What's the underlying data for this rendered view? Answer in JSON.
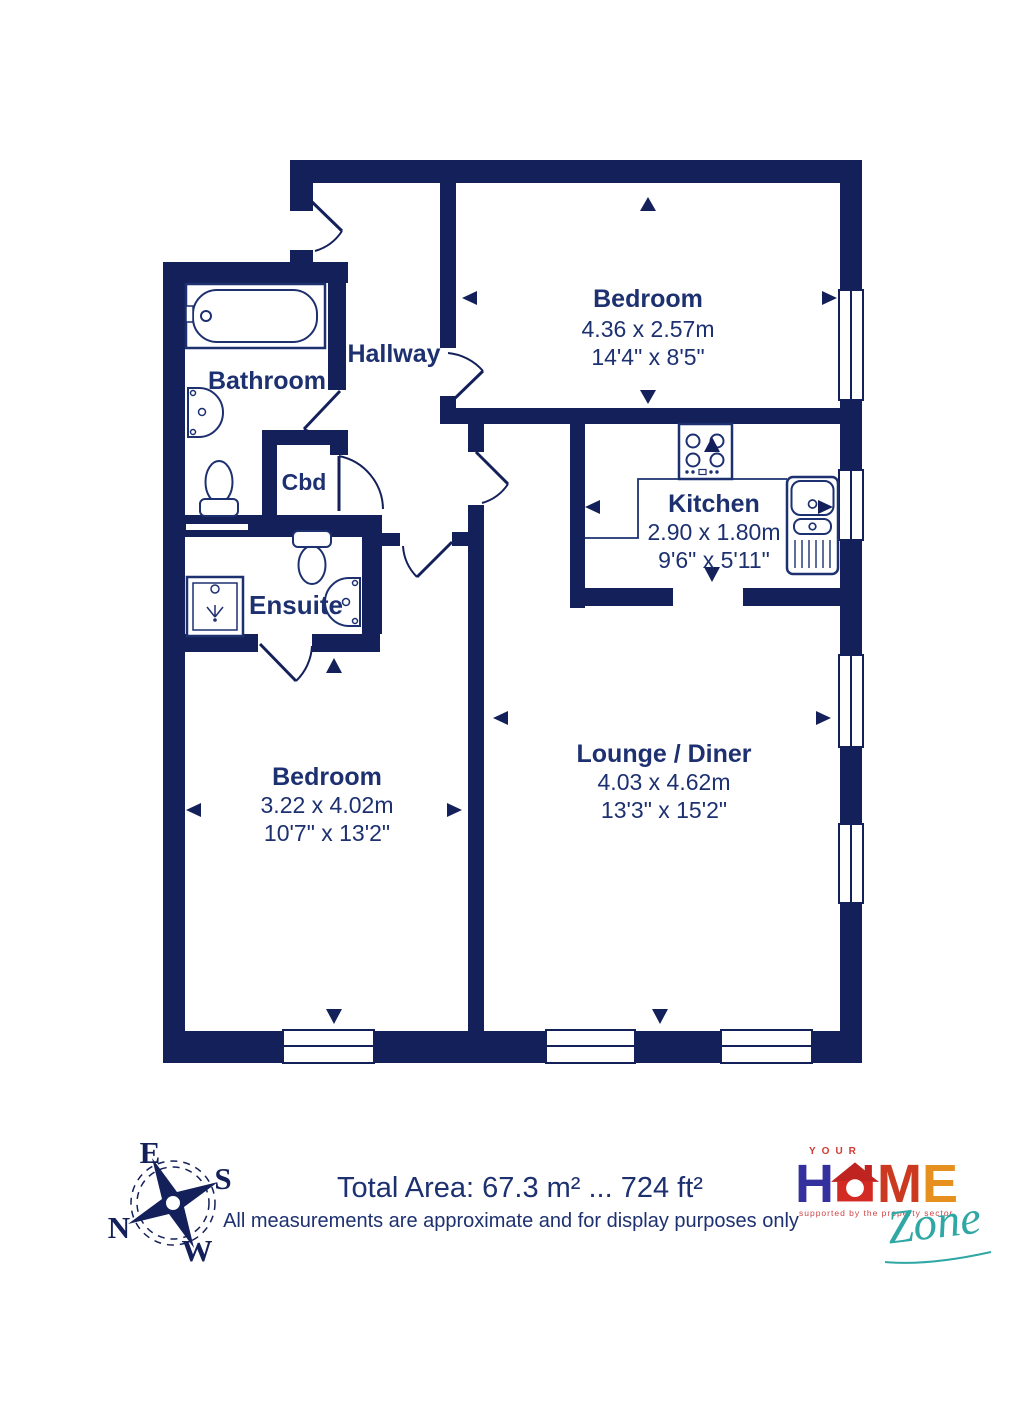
{
  "plan": {
    "wall_color": "#14205a",
    "text_color": "#1d3070",
    "rooms": {
      "bedroom_top": {
        "label": "Bedroom",
        "size_metric": "4.36 x 2.57m",
        "size_imperial": "14'4\" x 8'5\""
      },
      "kitchen": {
        "label": "Kitchen",
        "size_metric": "2.90 x 1.80m",
        "size_imperial": "9'6\" x 5'11\""
      },
      "lounge": {
        "label": "Lounge / Diner",
        "size_metric": "4.03 x 4.62m",
        "size_imperial": "13'3\" x 15'2\""
      },
      "bedroom_bottom": {
        "label": "Bedroom",
        "size_metric": "3.22 x 4.02m",
        "size_imperial": "10'7\" x 13'2\""
      },
      "hallway": {
        "label": "Hallway"
      },
      "bathroom": {
        "label": "Bathroom"
      },
      "cbd": {
        "label": "Cbd"
      },
      "ensuite": {
        "label": "Ensuite"
      }
    },
    "fixtures": [
      "bathtub",
      "bathroom-sink",
      "bathroom-toilet",
      "ensuite-toilet",
      "shower",
      "ensuite-sink",
      "hob",
      "kitchen-sink-unit"
    ]
  },
  "compass": {
    "north": "N",
    "east": "E",
    "south": "S",
    "west": "W"
  },
  "footer": {
    "total_area": "Total Area: 67.3 m² ... 724 ft²",
    "disclaimer": "All measurements are approximate and for display purposes only"
  },
  "logo": {
    "your": "YOUR",
    "home_h": "H",
    "home_m": "M",
    "home_e": "E",
    "tagline": "supported by the property sector",
    "zone": "Zone"
  }
}
